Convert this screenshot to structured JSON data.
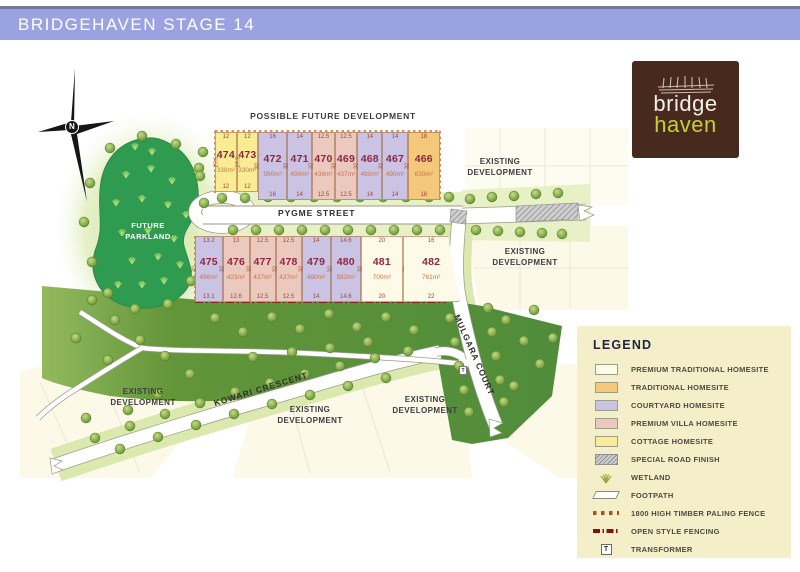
{
  "header": {
    "title": "BRIDGEHAVEN STAGE 14"
  },
  "logo": {
    "word1": "bridge",
    "word2": "haven"
  },
  "compass": {
    "north_label": "N"
  },
  "area_labels": {
    "possible_future_development": "POSSIBLE FUTURE DEVELOPMENT",
    "existing_development": "EXISTING DEVELOPMENT",
    "future_parkland": "FUTURE PARKLAND"
  },
  "streets": {
    "pygme": "PYGME STREET",
    "kowari": "KOWARI CRESCENT",
    "mulgara": "MULGARA COURT"
  },
  "lot_type_colors": {
    "premium_traditional": "#fdfbe7",
    "traditional": "#f3c87b",
    "courtyard": "#cbc3e4",
    "premium_villa": "#ecc9bf",
    "cottage": "#f9ec95"
  },
  "lots_top_row": [
    {
      "number": "474",
      "area": "330m²",
      "type": "cottage",
      "top_dim": "12",
      "bottom_dim": "12",
      "side_dim": "27.5"
    },
    {
      "number": "473",
      "area": "330m²",
      "type": "cottage",
      "top_dim": "12",
      "bottom_dim": "12",
      "side_dim": "27.5"
    },
    {
      "number": "472",
      "area": "560m²",
      "type": "courtyard",
      "top_dim": "16",
      "bottom_dim": "16",
      "side_dim": "32"
    },
    {
      "number": "471",
      "area": "490m²",
      "type": "courtyard",
      "top_dim": "14",
      "bottom_dim": "14",
      "side_dim": "32"
    },
    {
      "number": "470",
      "area": "438m²",
      "type": "premium_villa",
      "top_dim": "12.5",
      "bottom_dim": "12.5",
      "side_dim": "32"
    },
    {
      "number": "469",
      "area": "437m²",
      "type": "premium_villa",
      "top_dim": "12.5",
      "bottom_dim": "12.5",
      "side_dim": "32"
    },
    {
      "number": "468",
      "area": "490m²",
      "type": "courtyard",
      "top_dim": "14",
      "bottom_dim": "14",
      "side_dim": "32"
    },
    {
      "number": "467",
      "area": "490m²",
      "type": "courtyard",
      "top_dim": "14",
      "bottom_dim": "14",
      "side_dim": "32"
    },
    {
      "number": "466",
      "area": "630m²",
      "type": "traditional",
      "top_dim": "18",
      "bottom_dim": "18",
      "side_dim": "32"
    }
  ],
  "lots_bottom_row": [
    {
      "number": "475",
      "area": "496m²",
      "type": "courtyard",
      "top_dim": "13.2",
      "bottom_dim": "13.1",
      "side_dim": "32"
    },
    {
      "number": "476",
      "area": "423m²",
      "type": "premium_villa",
      "top_dim": "13",
      "bottom_dim": "12.6",
      "side_dim": "32"
    },
    {
      "number": "477",
      "area": "437m²",
      "type": "premium_villa",
      "top_dim": "12.5",
      "bottom_dim": "12.5",
      "side_dim": "32"
    },
    {
      "number": "478",
      "area": "437m²",
      "type": "premium_villa",
      "top_dim": "12.5",
      "bottom_dim": "12.5",
      "side_dim": "32"
    },
    {
      "number": "479",
      "area": "490m²",
      "type": "courtyard",
      "top_dim": "14",
      "bottom_dim": "14",
      "side_dim": "32"
    },
    {
      "number": "480",
      "area": "582m²",
      "type": "courtyard",
      "top_dim": "14.6",
      "bottom_dim": "14.6",
      "side_dim": "32"
    },
    {
      "number": "481",
      "area": "700m²",
      "type": "premium_traditional",
      "top_dim": "20",
      "bottom_dim": "20",
      "side_dim": "32"
    },
    {
      "number": "482",
      "area": "761m²",
      "type": "premium_traditional",
      "top_dim": "16",
      "bottom_dim": "22",
      "side_dim": "32"
    }
  ],
  "legend": {
    "title": "LEGEND",
    "items": [
      {
        "label": "PREMIUM TRADITIONAL HOMESITE",
        "icon": "swatch",
        "color": "#fdfbe7"
      },
      {
        "label": "TRADITIONAL HOMESITE",
        "icon": "swatch",
        "color": "#f3c87b"
      },
      {
        "label": "COURTYARD HOMESITE",
        "icon": "swatch",
        "color": "#cbc3e4"
      },
      {
        "label": "PREMIUM VILLA HOMESITE",
        "icon": "swatch",
        "color": "#ecc9bf"
      },
      {
        "label": "COTTAGE HOMESITE",
        "icon": "swatch",
        "color": "#f9ec95"
      },
      {
        "label": "SPECIAL ROAD FINISH",
        "icon": "hatch-swatch"
      },
      {
        "label": "WETLAND",
        "icon": "wetland-icon"
      },
      {
        "label": "FOOTPATH",
        "icon": "footpath-icon"
      },
      {
        "label": "1800 HIGH TIMBER PALING FENCE",
        "icon": "paling-fence-icon"
      },
      {
        "label": "OPEN STYLE FENCING",
        "icon": "open-fence-icon"
      },
      {
        "label": "TRANSFORMER",
        "icon": "transformer-icon",
        "letter": "T"
      }
    ]
  },
  "map_marks": {
    "transformer_letter": "T"
  }
}
